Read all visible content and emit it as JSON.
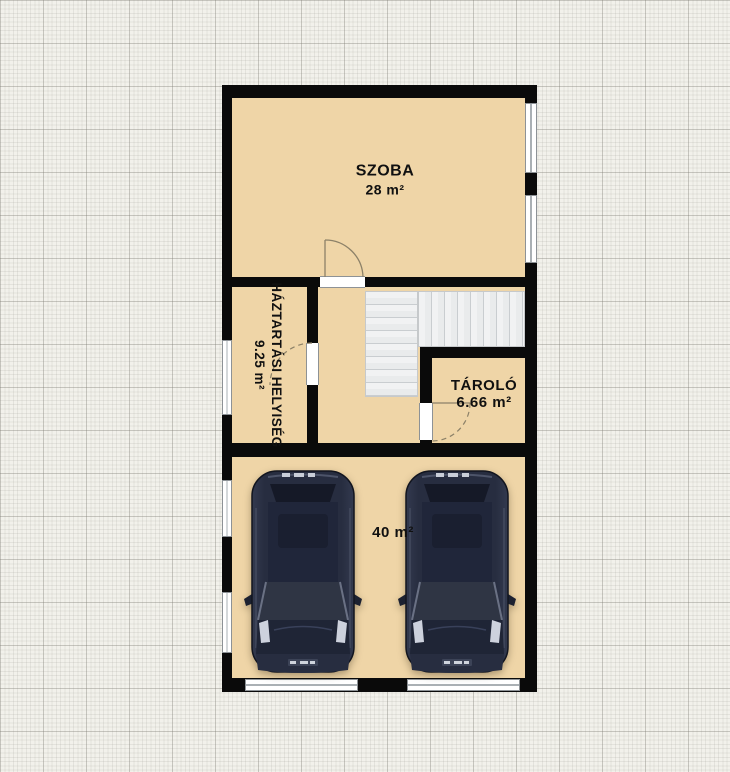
{
  "app": {
    "view": "floor-plan-canvas",
    "grid": {
      "minor_px": 4.3,
      "major_px": 43,
      "paper_color": "#f2f1eb",
      "minor_color": "#e4e3db",
      "major_color": "#c7c6be"
    }
  },
  "colors": {
    "room_fill": "#efd5a7",
    "wall": "#0a0a0a",
    "stair_tread": "#eceeef",
    "window_white": "#ffffff",
    "door_arc": "#8c8168",
    "car_body": "#272d40",
    "text": "#101010"
  },
  "rooms": {
    "szoba": {
      "name": "SZOBA",
      "area": "28 m²"
    },
    "haztartasi": {
      "name": "HÁZTARTÁSI HELYISÉG",
      "area": "9.25 m²"
    },
    "tarolo": {
      "name": "TÁROLÓ",
      "area": "6.66 m²"
    },
    "garage": {
      "area": "40 m²"
    }
  },
  "objects": {
    "cars": 2,
    "stairs": 1,
    "doors": 3,
    "windows": 5,
    "garage_doors": 2
  }
}
